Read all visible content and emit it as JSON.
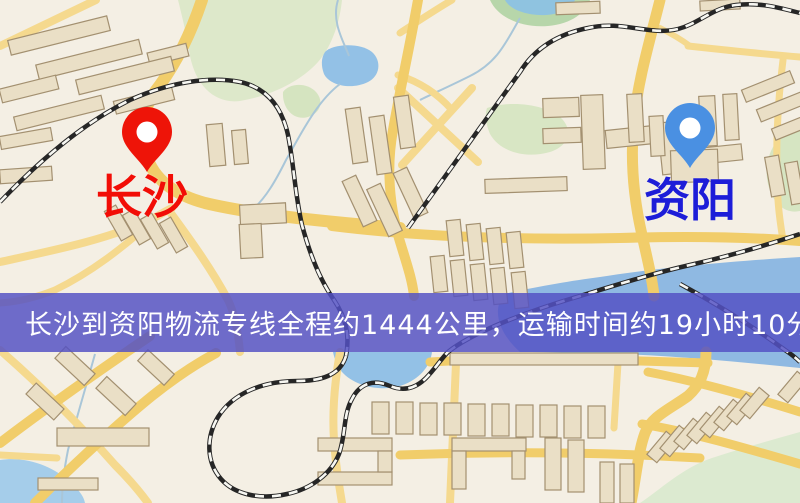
{
  "banner": {
    "text": "长沙到资阳物流专线全程约1444公里，运输时间约19小时10分钟.",
    "top": 293,
    "height": 59
  },
  "pins": {
    "origin": {
      "name": "长沙",
      "tip": [
        147,
        172
      ],
      "pin_color": "#ee1408",
      "hole_color": "#ffffff",
      "label_color": "#f20d06",
      "label_x": 142,
      "label_y": 174
    },
    "destination": {
      "name": "资阳",
      "tip": [
        690,
        168
      ],
      "pin_color": "#4a90e2",
      "hole_color": "#ffffff",
      "label_color": "#1d1dd8",
      "label_x": 690,
      "label_y": 177
    }
  },
  "colors": {
    "land": "#f4efe4",
    "road_major": "#f1cd6a",
    "road_minor": "#f5d98e",
    "railway_dark": "#262626",
    "railway_light": "#f7f7f2",
    "building_fill": "#eadfc6",
    "building_stroke": "#a39070",
    "stream": "#a9c6d8",
    "banner_bg": "rgba(84,81,196,0.84)",
    "banner_text": "#ffffff"
  },
  "map": {
    "width": 800,
    "height": 503,
    "greens": [
      {
        "d": "M178,0 L342,0 C340,20 333,45 318,62 C300,82 270,96 240,101 C215,104 196,86 190,56 C187,36 182,16 178,0 Z",
        "fill": "#dde8ca"
      },
      {
        "d": "M283,92 C289,83 307,82 316,92 C324,101 321,113 308,117 C294,121 282,109 283,92 Z",
        "fill": "#d5e4c0"
      },
      {
        "d": "M490,0 C498,18 522,28 548,26 C572,24 586,12 590,0 Z",
        "fill": "#b7d6aa"
      },
      {
        "d": "M487,108 C510,100 548,104 563,120 C573,132 568,146 550,152 C526,159 500,152 490,134 C485,122 485,114 487,108 Z",
        "fill": "#d8e6c4"
      },
      {
        "d": "M800,126 C776,132 762,158 768,184 C773,205 786,214 800,211 Z",
        "fill": "#d6e5c2"
      },
      {
        "d": "M640,503 C660,490 682,468 712,458 C742,448 772,440 800,432 L800,503 Z",
        "fill": "#dcead0"
      }
    ],
    "waters": [
      {
        "d": "M325,52 C332,44 360,42 372,52 C382,61 380,76 368,82 C352,90 330,86 324,74 C321,66 321,58 325,52 Z",
        "fill": "#93c1e6"
      },
      {
        "d": "M520,352 C498,332 492,310 504,294 C540,286 570,281 600,277 C650,269 720,262 800,257 L800,368 C740,362 680,356 620,354 C585,353 550,352 520,352 Z",
        "fill": "#8fb9e2"
      },
      {
        "d": "M333,352 L432,352 C430,368 417,382 396,387 C370,392 347,381 339,368 C336,362 334,357 333,352 Z",
        "fill": "#93c1e6"
      },
      {
        "d": "M0,460 C28,456 54,467 70,482 C80,491 84,497 85,503 L0,503 Z",
        "fill": "#a5cdea"
      },
      {
        "d": "M505,0 C510,10 528,16 546,15 C562,14 572,7 575,0 Z",
        "fill": "#8fc3e0"
      }
    ],
    "streams": [
      "M338,0 C331,22 344,42 349,56",
      "M340,84 C316,102 300,136 286,160 C276,180 266,198 252,210",
      "M520,18 C506,42 498,62 470,76 C448,87 432,94 420,100",
      "M95,354 C85,390 76,420 68,450 C64,470 62,486 62,503"
    ],
    "roads_minor": [
      {
        "d": "M0,46 L96,0",
        "w": 8
      },
      {
        "d": "M0,262 C55,250 105,240 150,220 C158,216 164,212 172,208",
        "w": 8
      },
      {
        "d": "M170,212 C192,242 212,270 228,300 C234,312 238,330 240,352",
        "w": 8
      },
      {
        "d": "M152,222 C122,248 92,272 55,290 C35,298 15,302 0,303",
        "w": 7
      },
      {
        "d": "M400,33 C420,20 435,10 452,0",
        "w": 7
      },
      {
        "d": "M398,88 L478,162",
        "w": 8
      },
      {
        "d": "M472,88 L402,165",
        "w": 8
      },
      {
        "d": "M398,75 C420,82 438,94 452,110",
        "w": 7
      },
      {
        "d": "M688,46 C725,50 762,54 800,57",
        "w": 7
      },
      {
        "d": "M660,28 C672,34 682,40 690,46",
        "w": 6
      },
      {
        "d": "M783,60 C778,100 775,150 778,200 C779,215 781,228 783,240",
        "w": 7
      },
      {
        "d": "M456,363 L450,503",
        "w": 8
      },
      {
        "d": "M618,363 L614,428",
        "w": 7
      },
      {
        "d": "M340,352 C335,380 332,410 334,440 C336,470 340,490 342,503",
        "w": 8
      },
      {
        "d": "M0,350 C40,385 80,425 115,465 C130,480 140,492 148,503",
        "w": 8
      },
      {
        "d": "M0,455 L57,458",
        "w": 7
      }
    ],
    "roads_major": [
      {
        "d": "M202,0 C192,30 178,60 160,85 C140,110 138,135 148,160 C156,180 175,195 205,203 C255,215 330,222 400,228",
        "w": 12
      },
      {
        "d": "M332,226 C420,237 520,240 620,238 C685,236 748,237 800,241",
        "w": 10
      },
      {
        "d": "M660,0 C650,40 638,80 634,120 C630,160 634,200 642,235 C648,262 652,278 654,296",
        "w": 11
      },
      {
        "d": "M706,352 C706,372 700,385 688,396 C670,409 652,416 645,433 C638,452 636,478 631,503",
        "w": 11
      },
      {
        "d": "M418,0 C410,45 400,90 393,130 C386,168 390,205 398,235 C406,262 412,278 414,296",
        "w": 10
      },
      {
        "d": "M0,443 C50,405 100,370 150,336",
        "w": 10
      },
      {
        "d": "M35,503 C60,478 110,430 152,396 C172,380 192,366 216,353",
        "w": 10
      },
      {
        "d": "M648,372 C695,381 742,394 800,412",
        "w": 9
      },
      {
        "d": "M642,424 C690,432 742,447 800,464",
        "w": 9
      },
      {
        "d": "M430,362 C500,358 570,358 640,361 L708,363",
        "w": 9
      },
      {
        "d": "M400,455 C480,452 560,452 640,455 L700,458",
        "w": 9
      }
    ],
    "railways": [
      "M0,202 C40,160 85,122 130,100 C170,82 210,76 240,82 C268,88 282,108 288,135 C294,165 295,195 302,225 C310,255 320,280 334,300 C346,318 350,335 346,356",
      "M346,356 C340,376 320,381 297,381 C263,381 233,393 218,417 C206,437 206,462 221,479 C235,495 261,500 287,494 C311,489 331,474 339,454 C346,434 343,415 352,399 C360,383 374,379 390,386 C402,391 414,390 426,378 C435,369 441,359 448,352",
      "M448,352 C470,334 520,314 570,299 C610,287 650,274 690,265 C730,256 770,244 800,234",
      "M408,228 L520,72 C535,48 558,34 588,28 C622,20 650,36 678,29 C700,23 712,8 736,5 C760,2 780,8 800,13",
      "M680,284 C720,306 755,328 785,350 C791,354 796,358 800,362"
    ],
    "buildings": [
      [
        8,
        28,
        102,
        15,
        -14
      ],
      [
        36,
        52,
        106,
        15,
        -14
      ],
      [
        148,
        48,
        40,
        13,
        -14
      ],
      [
        0,
        82,
        58,
        14,
        -14
      ],
      [
        76,
        68,
        98,
        15,
        -14
      ],
      [
        14,
        106,
        90,
        14,
        -14
      ],
      [
        114,
        94,
        60,
        13,
        -14
      ],
      [
        0,
        132,
        52,
        13,
        -10
      ],
      [
        0,
        168,
        52,
        14,
        -4
      ],
      [
        208,
        124,
        16,
        42,
        -5
      ],
      [
        233,
        130,
        14,
        34,
        -5
      ],
      [
        349,
        108,
        15,
        55,
        -8
      ],
      [
        373,
        116,
        15,
        58,
        -8
      ],
      [
        397,
        96,
        15,
        52,
        -8
      ],
      [
        352,
        176,
        15,
        50,
        -25
      ],
      [
        377,
        184,
        15,
        52,
        -25
      ],
      [
        403,
        168,
        15,
        50,
        -25
      ],
      [
        112,
        206,
        13,
        34,
        -30
      ],
      [
        130,
        210,
        13,
        34,
        -30
      ],
      [
        148,
        214,
        13,
        34,
        -30
      ],
      [
        167,
        218,
        13,
        34,
        -30
      ],
      [
        240,
        204,
        46,
        20,
        -3
      ],
      [
        240,
        224,
        22,
        34,
        -3
      ],
      [
        448,
        220,
        14,
        36,
        -6
      ],
      [
        468,
        224,
        14,
        36,
        -6
      ],
      [
        488,
        228,
        14,
        36,
        -6
      ],
      [
        508,
        232,
        14,
        36,
        -6
      ],
      [
        432,
        256,
        14,
        36,
        -6
      ],
      [
        452,
        260,
        14,
        36,
        -6
      ],
      [
        472,
        264,
        14,
        36,
        -6
      ],
      [
        492,
        268,
        14,
        36,
        -6
      ],
      [
        513,
        272,
        14,
        36,
        -6
      ],
      [
        543,
        98,
        36,
        19,
        -2
      ],
      [
        543,
        128,
        38,
        15,
        -2
      ],
      [
        582,
        95,
        22,
        74,
        -2
      ],
      [
        485,
        178,
        82,
        14,
        -2
      ],
      [
        606,
        128,
        48,
        18,
        -6
      ],
      [
        660,
        122,
        20,
        52,
        -6
      ],
      [
        700,
        146,
        42,
        16,
        -6
      ],
      [
        671,
        150,
        47,
        32,
        -2
      ],
      [
        628,
        94,
        15,
        48,
        -3
      ],
      [
        650,
        116,
        14,
        40,
        -3
      ],
      [
        742,
        80,
        52,
        13,
        -22
      ],
      [
        757,
        100,
        50,
        13,
        -22
      ],
      [
        772,
        120,
        46,
        12,
        -22
      ],
      [
        768,
        156,
        14,
        40,
        -10
      ],
      [
        788,
        162,
        13,
        42,
        -10
      ],
      [
        556,
        2,
        44,
        12,
        -2
      ],
      [
        700,
        0,
        40,
        10,
        -3
      ],
      [
        700,
        96,
        16,
        50,
        -3
      ],
      [
        724,
        94,
        14,
        46,
        -3
      ],
      [
        372,
        402,
        17,
        32,
        0
      ],
      [
        396,
        402,
        17,
        32,
        0
      ],
      [
        420,
        403,
        17,
        32,
        0
      ],
      [
        444,
        403,
        17,
        32,
        0
      ],
      [
        468,
        404,
        17,
        32,
        0
      ],
      [
        492,
        404,
        17,
        32,
        0
      ],
      [
        516,
        405,
        17,
        32,
        0
      ],
      [
        540,
        405,
        17,
        32,
        0
      ],
      [
        564,
        406,
        17,
        32,
        0
      ],
      [
        588,
        406,
        17,
        32,
        0
      ],
      [
        450,
        353,
        188,
        12,
        0
      ],
      [
        452,
        438,
        74,
        13,
        0
      ],
      [
        452,
        451,
        14,
        38,
        0
      ],
      [
        512,
        451,
        13,
        28,
        0
      ],
      [
        318,
        438,
        74,
        13,
        0
      ],
      [
        318,
        472,
        74,
        13,
        0
      ],
      [
        378,
        451,
        14,
        21,
        0
      ],
      [
        545,
        438,
        16,
        52,
        0
      ],
      [
        568,
        440,
        16,
        52,
        0
      ],
      [
        600,
        462,
        14,
        41,
        0
      ],
      [
        620,
        464,
        14,
        39,
        0
      ],
      [
        57,
        428,
        92,
        18,
        0
      ],
      [
        38,
        478,
        60,
        12,
        0
      ],
      [
        55,
        358,
        40,
        16,
        43
      ],
      [
        96,
        388,
        40,
        16,
        43
      ],
      [
        26,
        394,
        38,
        15,
        43
      ],
      [
        138,
        360,
        36,
        15,
        43
      ],
      [
        655,
        432,
        13,
        30,
        40
      ],
      [
        668,
        426,
        13,
        30,
        40
      ],
      [
        682,
        419,
        13,
        30,
        40
      ],
      [
        695,
        413,
        13,
        30,
        40
      ],
      [
        708,
        407,
        13,
        30,
        40
      ],
      [
        722,
        400,
        13,
        30,
        40
      ],
      [
        735,
        394,
        13,
        30,
        40
      ],
      [
        748,
        388,
        13,
        30,
        40
      ],
      [
        786,
        372,
        13,
        30,
        40
      ]
    ]
  }
}
